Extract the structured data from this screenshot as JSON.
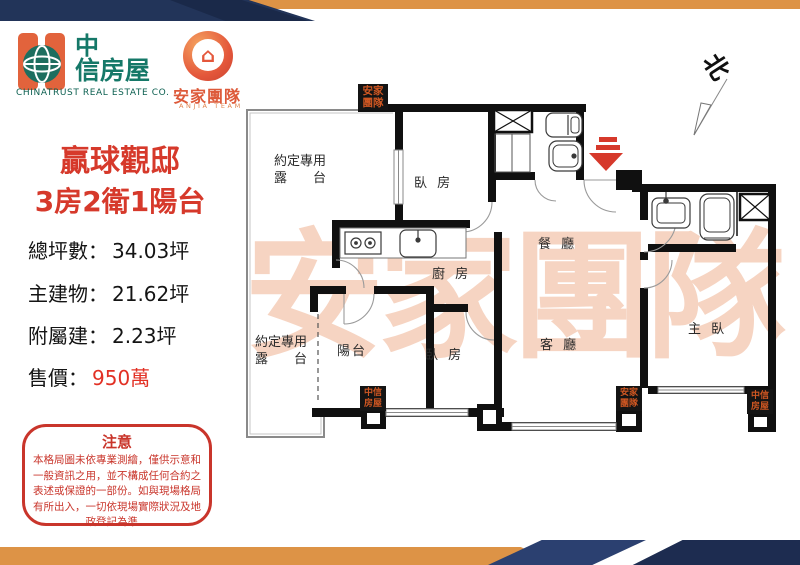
{
  "brand": {
    "chinatrust_line1": "中",
    "chinatrust_line2": "信房屋",
    "chinatrust_en": "CHINATRUST  REAL  ESTATE  CO.",
    "anjia_name": "安家團隊",
    "anjia_en": "ANJIA TEAM"
  },
  "listing": {
    "title": "贏球觀邸",
    "subtitle": "3房2衛1陽台",
    "specs": [
      {
        "label": "總坪數：",
        "value": "34.03坪"
      },
      {
        "label": "主建物：",
        "value": "21.62坪"
      },
      {
        "label": "附屬建：",
        "value": "2.23坪"
      }
    ],
    "price_label": "售價：",
    "price_value": "950萬"
  },
  "notice": {
    "title": "注意",
    "body": "本格局圖未依專業測繪，僅供示意和一般資訊之用，並不構成任何合約之表述或保證的一部份。如與現場格局有所出入，一切依現場實際狀況及地政登記為準。"
  },
  "plan": {
    "watermark": "安家團隊",
    "north": "北",
    "rooms": {
      "terrace_top_l1": "約定專用",
      "terrace_top_l2": "露　　台",
      "terrace_bottom_l1": "約定專用",
      "terrace_bottom_l2": "露　　台",
      "bedroom1": "臥 房",
      "bedroom2": "臥 房",
      "kitchen": "廚 房",
      "dining": "餐 廳",
      "living": "客 廳",
      "master": "主 臥",
      "balcony": "陽台"
    },
    "stamps": [
      "安家團隊",
      "中信房屋",
      "安家團隊",
      "中信房屋"
    ]
  },
  "colors": {
    "accent_red": "#d6392b",
    "price_red": "#e23024",
    "navy": "#223459",
    "orange": "#dd9346",
    "stamp_text": "#cf5722",
    "watermark": "#e87842",
    "logo_green": "#157868",
    "logo_orange": "#e2633c"
  }
}
